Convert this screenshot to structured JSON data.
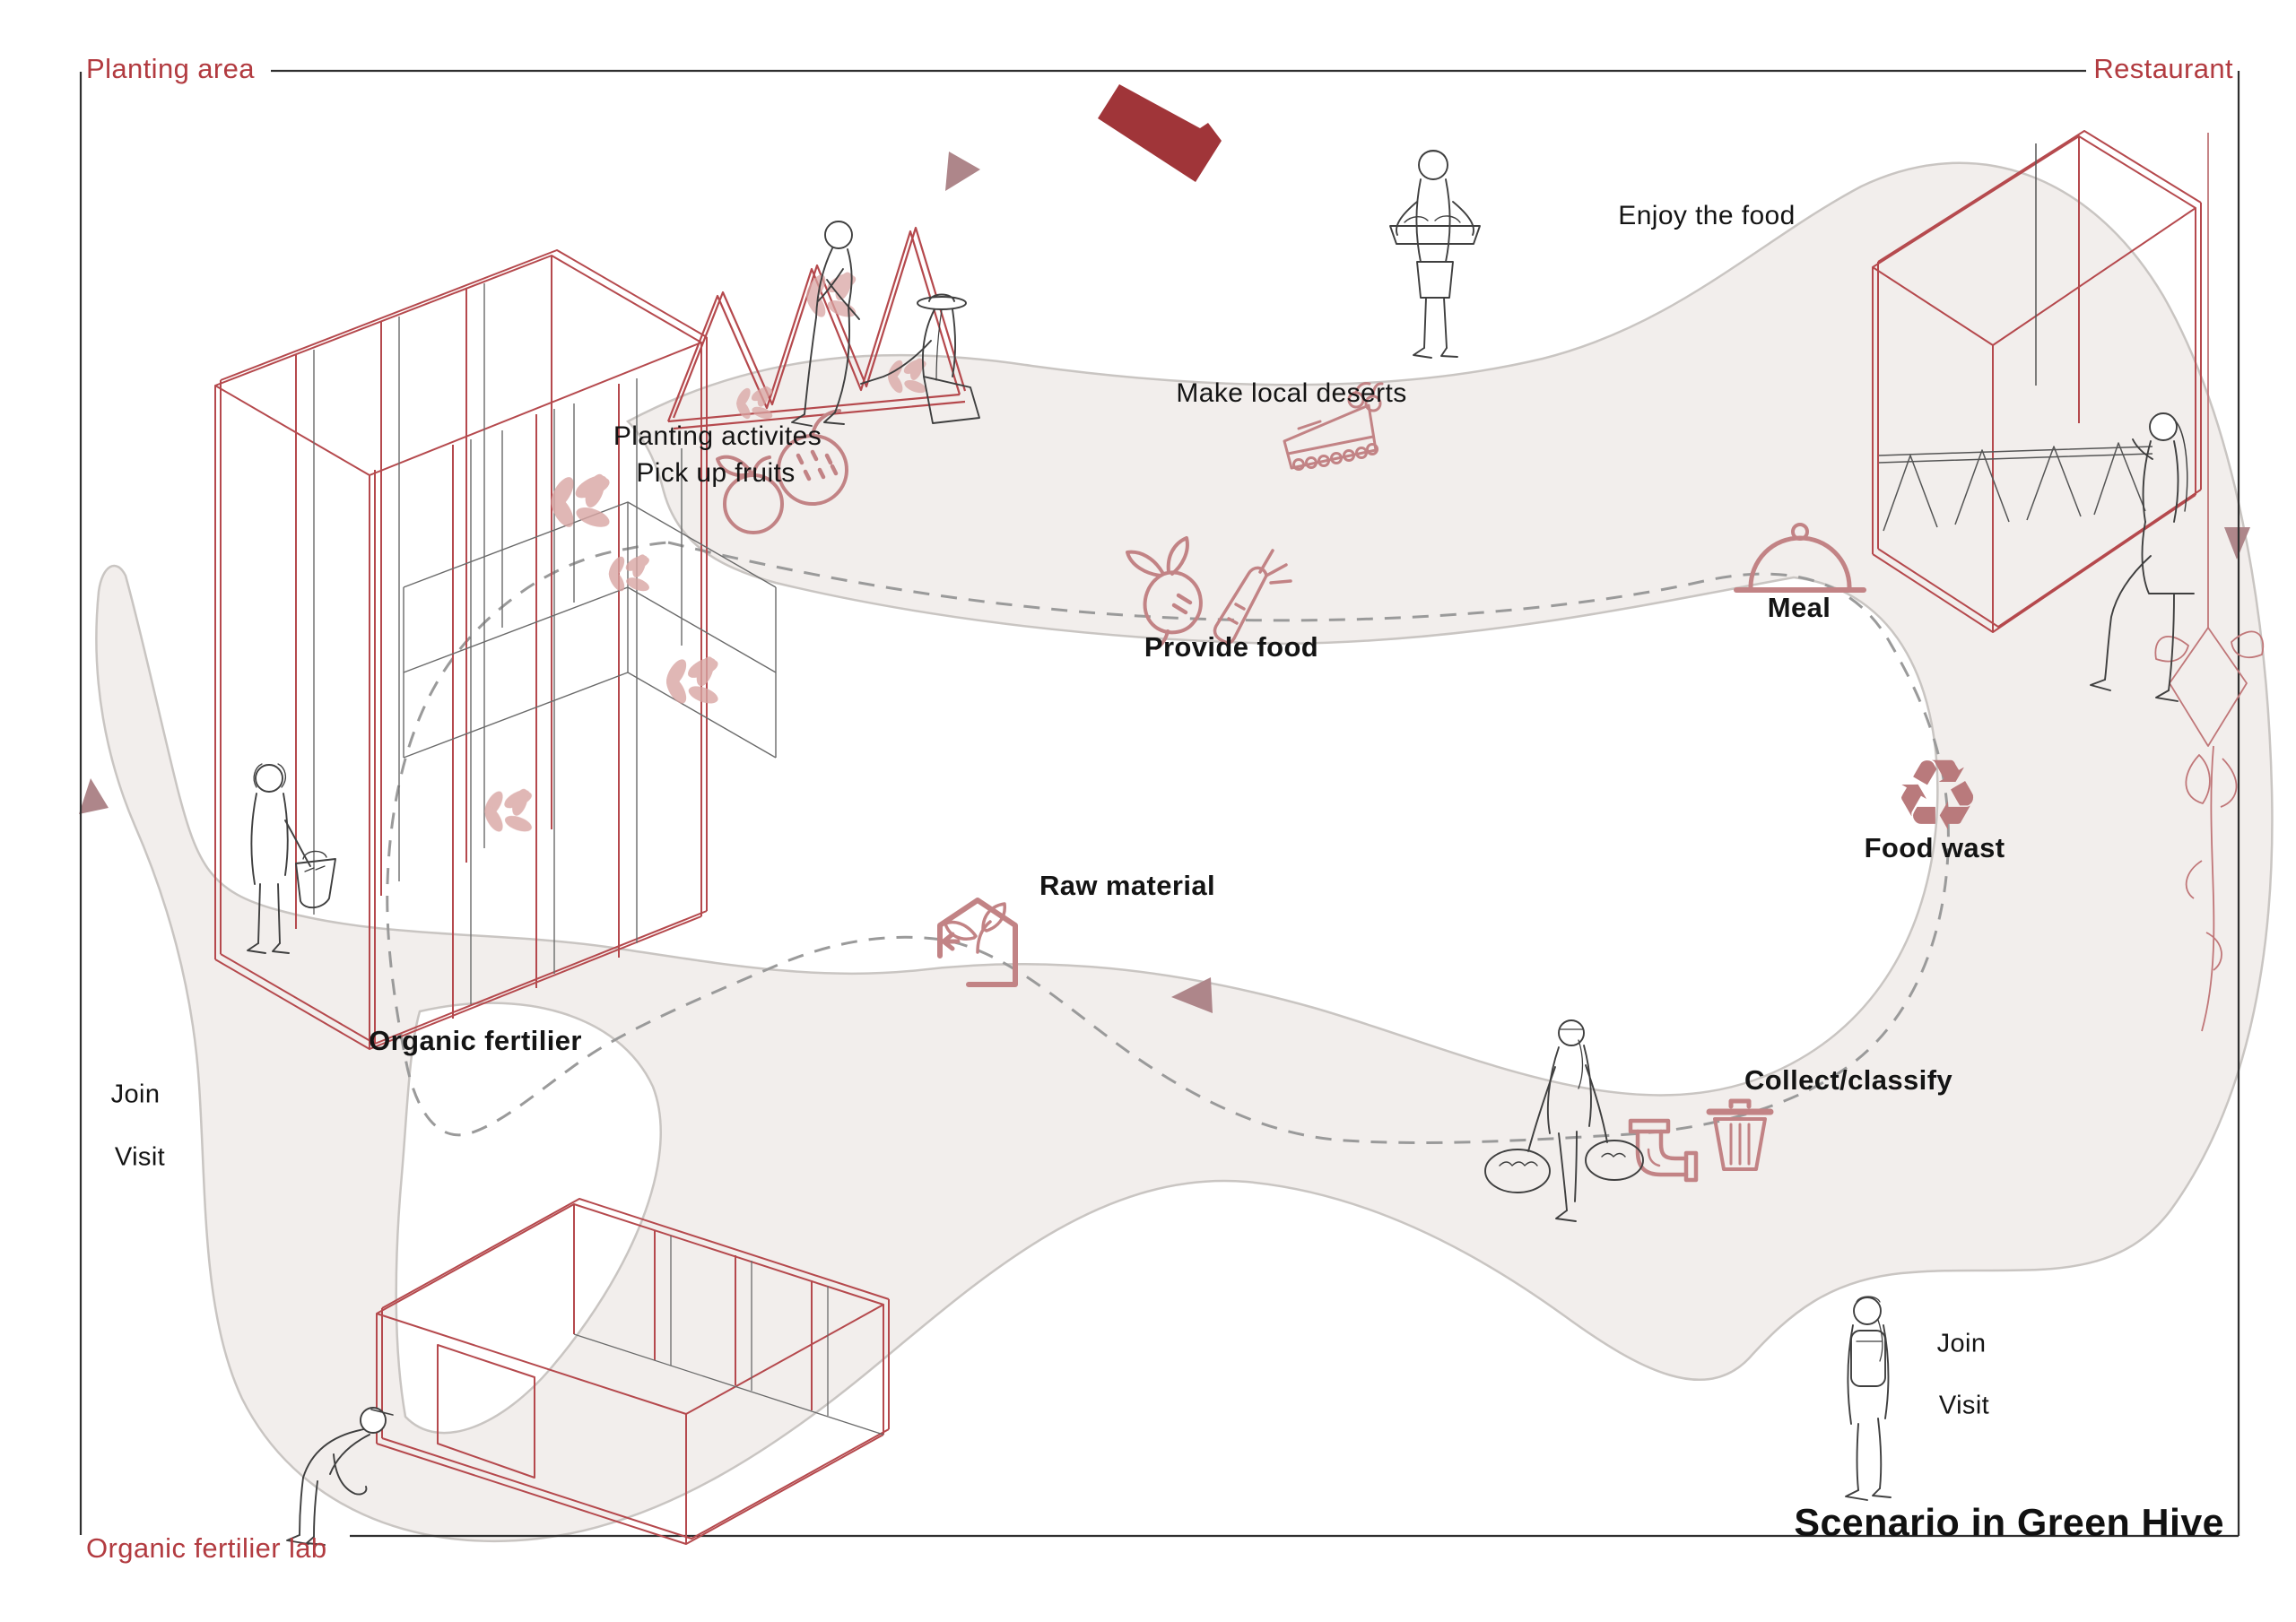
{
  "frame": {
    "top_left_label": "Planting area",
    "top_right_label": "Restaurant",
    "bottom_left_label": "Organic fertilier lab",
    "title": "Scenario in Green Hive"
  },
  "cycle": {
    "provide_food": "Provide food",
    "meal": "Meal",
    "food_wast": "Food wast",
    "collect_classify": "Collect/classify",
    "raw_material": "Raw material",
    "organic_fertilier": "Organic fertilier"
  },
  "activities": {
    "planting_line1": "Planting activites",
    "planting_line2": "Pick up fruits",
    "make_local_deserts": "Make local deserts",
    "enjoy_the_food": "Enjoy the food"
  },
  "participation": {
    "left": {
      "join": "Join",
      "visit": "Visit"
    },
    "right": {
      "join": "Join",
      "visit": "Visit"
    }
  },
  "glyphs": {
    "recycle": "♻"
  },
  "icons": [
    "apple-icon",
    "strawberry-icon",
    "cake-icon",
    "radish-icon",
    "carrot-icon",
    "cloche-icon",
    "recycle-icon",
    "pipe-icon",
    "trash-bin-icon",
    "compost-house-icon",
    "leaf-cluster-icon",
    "hanging-plant-icon"
  ],
  "colors": {
    "accent_red": "#b23b40",
    "logo_red": "#a03539",
    "icon_rose": "#c28385",
    "blob_fill": "#f2eeec",
    "blob_stroke": "#c9c5c2",
    "dash_gray": "#9a9a9a",
    "arrow_mauve": "#ae868a",
    "wireframe_red": "#b5494d",
    "figure_line": "#3f3f3f",
    "title_black": "#111111"
  }
}
